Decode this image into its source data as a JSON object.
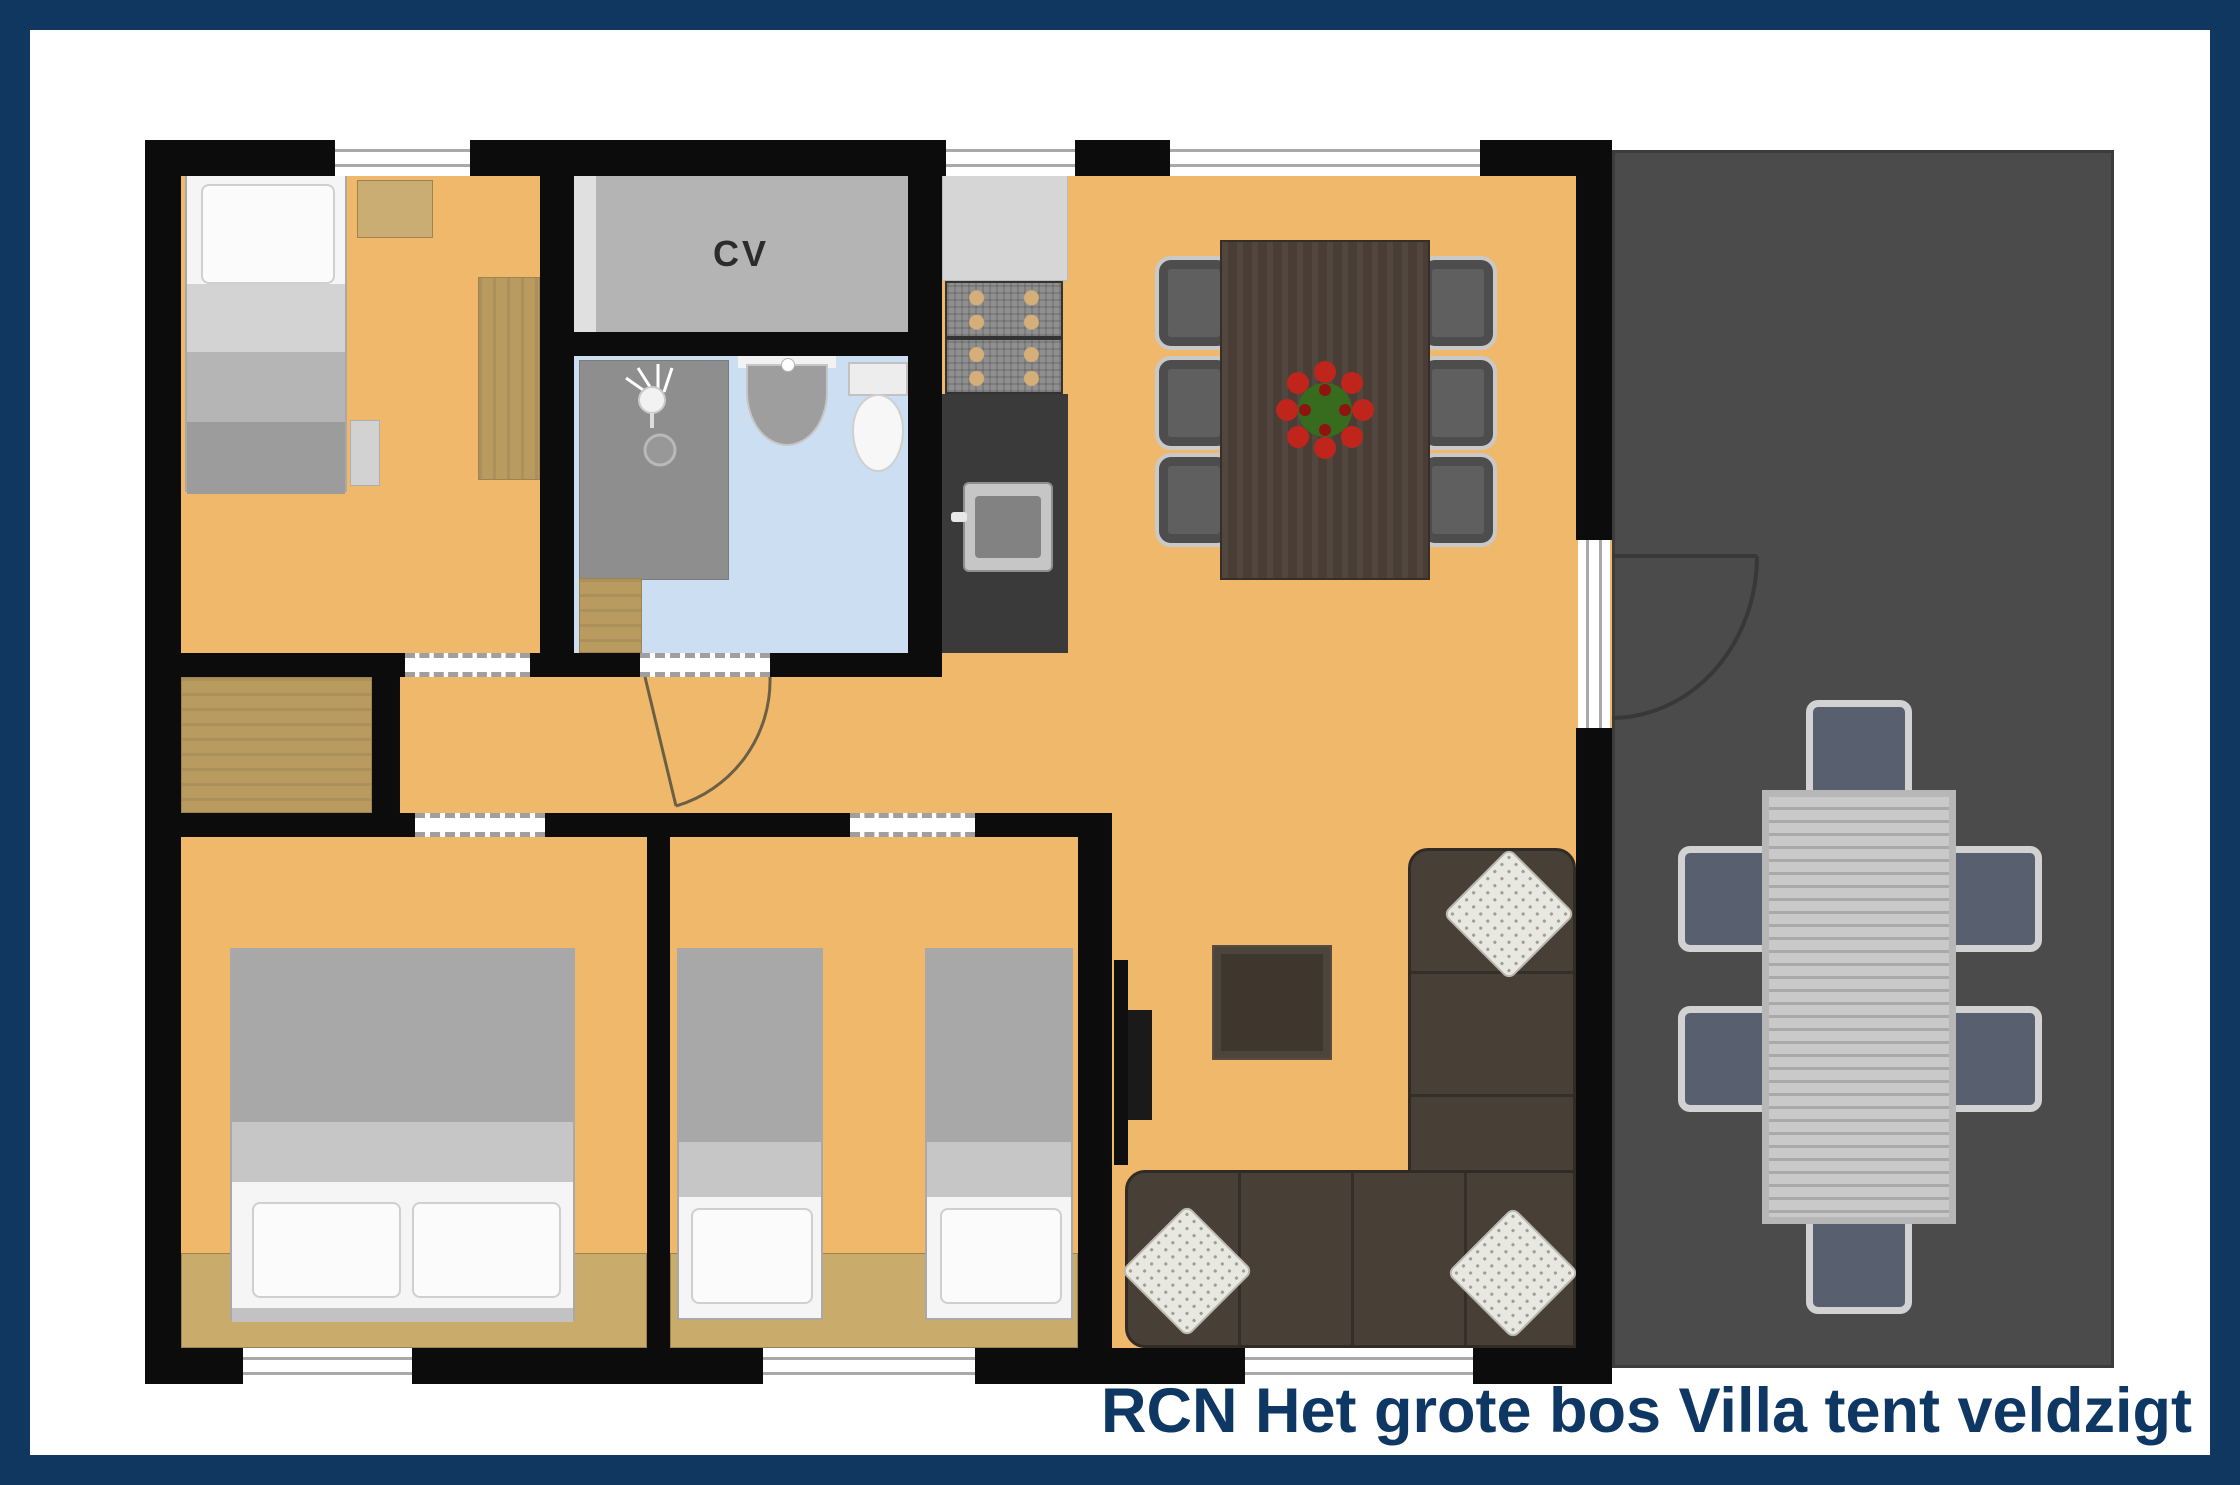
{
  "title": {
    "text": "RCN Het grote bos Villa tent veldzigt"
  },
  "labels": {
    "cv": "CV"
  },
  "colors": {
    "border_navy": "#10375f",
    "title_navy": "#0e3763",
    "floor_orange": "#efb86a",
    "wall_black": "#0c0c0c",
    "terrace_gray": "#4b4b4b",
    "bathroom_blue": "#cbdef2",
    "cv_gray": "#b4b4b4",
    "wood_tan": "#b99b60",
    "sofa_brown": "#483f37",
    "dining_table_brown": "#493d35",
    "counter_dark": "#3a3a3a",
    "counter_light": "#d6d6d6",
    "chair_gray": "#5f5f5f",
    "outdoor_seat_slate": "#586070",
    "stove_knob": "#d4af79",
    "flower_red": "#c0251c",
    "flower_green": "#376b1e"
  }
}
